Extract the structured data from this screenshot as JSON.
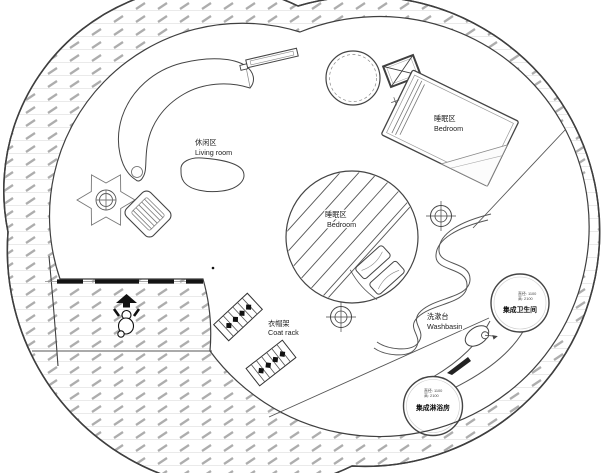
{
  "document": {
    "type": "circular house floor plan drawing",
    "background": "#ffffff"
  },
  "areas": {
    "living_room": {
      "label_zh": "休闲区",
      "label_en": "Living room"
    },
    "bedroom_upper": {
      "label_zh": "睡眠区",
      "label_en": "Bedroom"
    },
    "bedroom_center": {
      "label_zh": "睡眠区",
      "label_en": "Bedroom"
    },
    "coat_rack": {
      "label_zh": "衣帽架",
      "label_en": "Coat rack"
    },
    "washbasin": {
      "label_zh": "洗漱台",
      "label_en": "Washbasin"
    },
    "toilet_pod": {
      "label_zh": "集成卫生间",
      "spec_diameter": "直径: 1100",
      "spec_height": "高: 2100"
    },
    "shower_pod": {
      "label_zh": "集成淋浴房",
      "spec_diameter": "直径: 1100",
      "spec_height": "高: 2100"
    }
  },
  "symbols": {
    "person": "scale-figure at entrance",
    "plant": "potted plant",
    "column_markers": 2
  },
  "colors": {
    "wall_line": "#3f3f3f",
    "hatch_dash": "#adadad",
    "light_line": "#e3e3e3",
    "text": "#222222"
  }
}
